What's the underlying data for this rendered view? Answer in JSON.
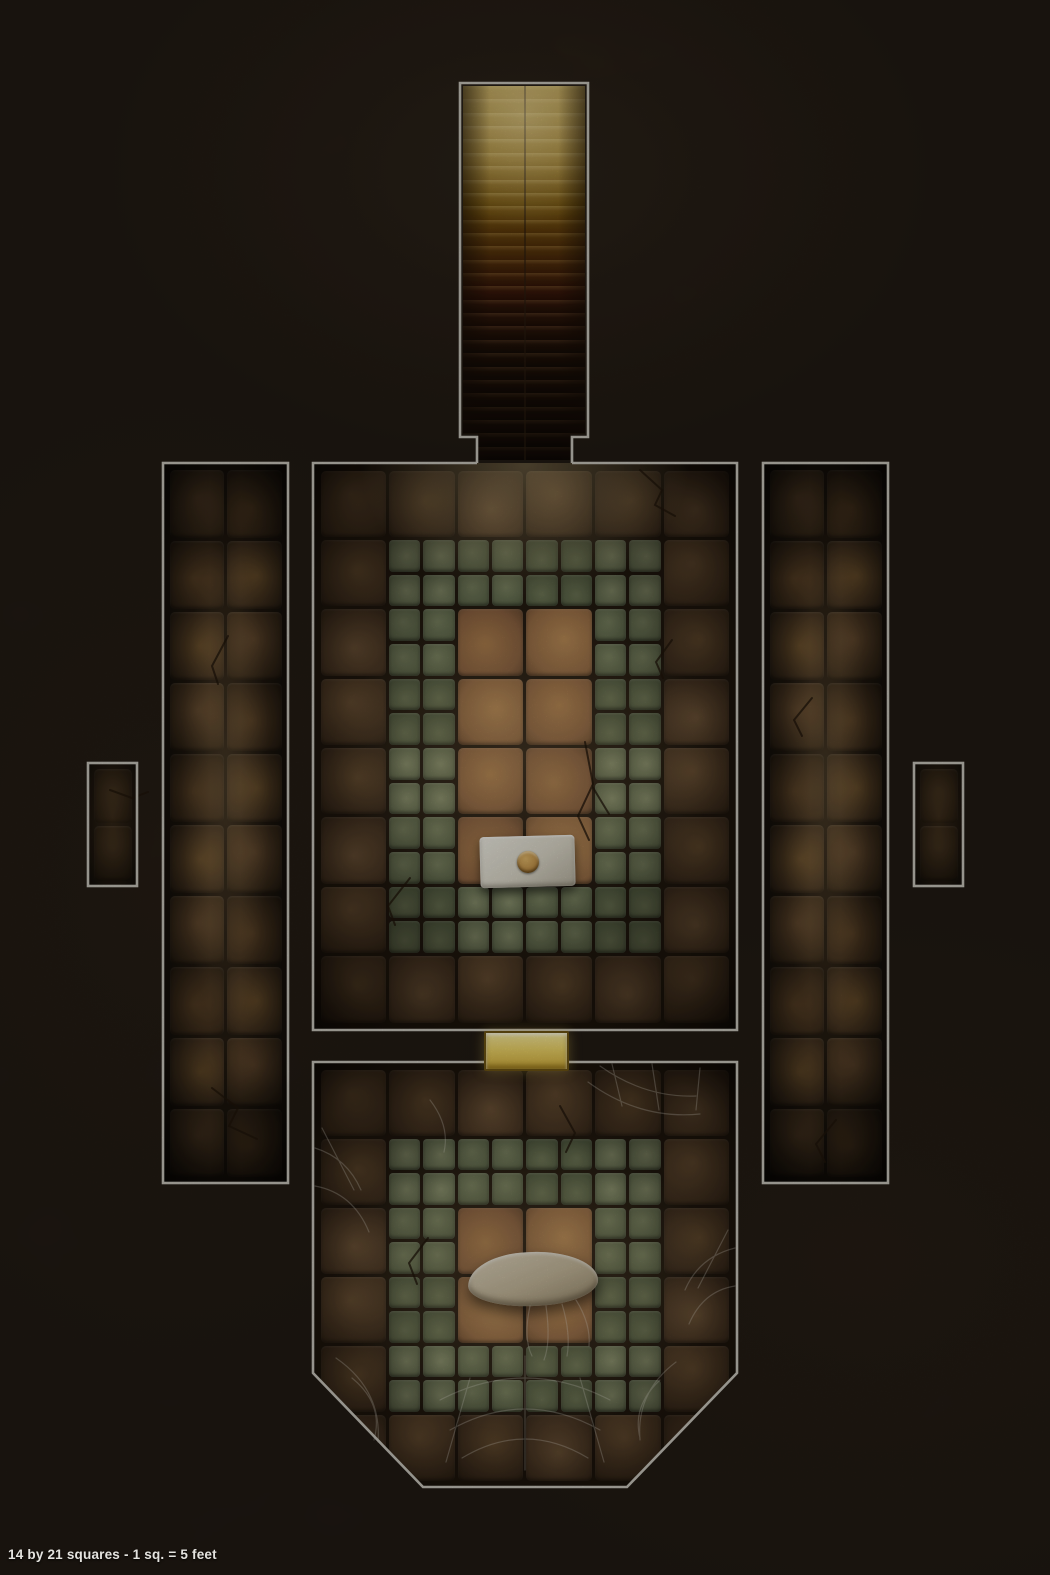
{
  "caption": "14 by 21 squares - 1 sq. = 5 feet",
  "map": {
    "grid": {
      "squares_wide": 14,
      "squares_high": 21,
      "feet_per_square": 5
    },
    "colors": {
      "background": "#211a14",
      "room_outline": "#c9c6bd",
      "grout": "#2b2015",
      "brown_tile": "#6e5136",
      "center_brown_tile": "#9a7148",
      "green_mosaic_tile": "#6d7557",
      "corridor_tile": "#57402a",
      "stair_light": "#e9d7a3",
      "door_gold": "#eed569",
      "plate_silver": "#ddd9ca",
      "plate_button_gold": "#c3934a",
      "slab_stone": "#c4b79a",
      "cobweb": "#d8d5cc",
      "caption_text": "#e4e3df"
    },
    "staircase": {
      "steps": 28
    },
    "main_chamber": {
      "cols": 6,
      "rows": 8,
      "tiles": [
        "BBBBBB",
        "BGGGGB",
        "BGRRGB",
        "BGRRGB",
        "BGRRGB",
        "BGRRGB",
        "BGGGGB",
        "BBBBBB"
      ]
    },
    "crypt_chamber": {
      "cols": 6,
      "rows": 6,
      "tiles": [
        "BBBBBB",
        "BGGGGB",
        "BGRRGB",
        "BGRRGB",
        "BGGGGB",
        "BBBBBB"
      ]
    },
    "west_corridor": {
      "cols": 2,
      "rows": 10,
      "tiles": [
        "CC",
        "CC",
        "CC",
        "CC",
        "CC",
        "CC",
        "CC",
        "CC",
        "CC",
        "CC"
      ]
    },
    "east_corridor": {
      "cols": 2,
      "rows": 10,
      "tiles": [
        "CC",
        "CC",
        "CC",
        "CC",
        "CC",
        "CC",
        "CC",
        "CC",
        "CC",
        "CC"
      ]
    },
    "west_alcove": {
      "cols": 1,
      "rows": 2,
      "tiles": [
        "D",
        "D"
      ]
    },
    "east_alcove": {
      "cols": 1,
      "rows": 2,
      "tiles": [
        "D",
        "D"
      ]
    }
  }
}
